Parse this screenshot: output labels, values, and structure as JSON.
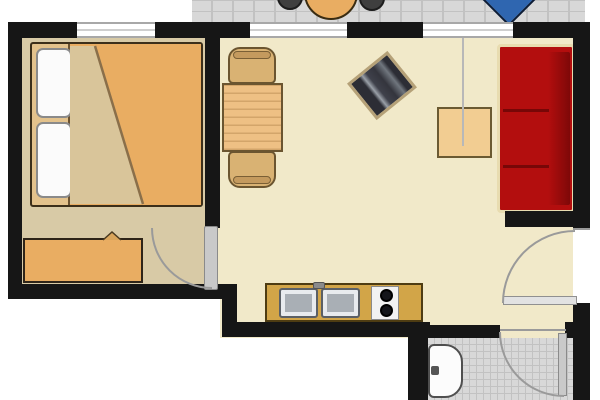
{
  "meta": {
    "type": "apartment-floor-plan",
    "width_px": 600,
    "height_px": 400,
    "text_labels": []
  },
  "palette": {
    "wall": "#161616",
    "exterior": "#ffffff",
    "bedroomFloor": "#d8caa6",
    "livingFloor": "#f1e9c9",
    "tileFloor": "#d8d8d8",
    "tileLine": "#c2c2c2",
    "accentOrange": "#e9ad62",
    "bedFrame": "#e3c28c",
    "foldBeige": "#d9c59a",
    "pillowWhite": "#fbfbfb",
    "woodTable": "#eec084",
    "woodChair": "#d9b273",
    "woodOutline": "#6b5530",
    "counterWood": "#d2a548",
    "sofaRed": "#b30e0e",
    "sofaRedDark": "#7e0808",
    "sofaTrim": "#e8dcb0",
    "coffeeTable": "#f2cd92",
    "tvBody": "#2c2d35",
    "tvStripe": "#9aa0a8",
    "tvFrame": "#b5a178",
    "loungerBlue": "#2f66b0",
    "loungerNavy": "#16335e",
    "doorLeaf": "#c9c9c9",
    "arcLine": "#9a9a9a",
    "sinkSteel": "#a9afb5",
    "stoveWhite": "#f2f2f2",
    "burnerBlack": "#14151a",
    "toiletWhite": "#fcfcfc"
  },
  "rooms": {
    "balcony": {
      "floor": "gray-tile",
      "items": [
        "round-table",
        "chair",
        "chair",
        "sun-lounger"
      ]
    },
    "bedroom": {
      "floor": "tan",
      "items": [
        "double-bed",
        "pillow",
        "pillow",
        "duvet",
        "sideboard"
      ],
      "doors": [
        "door-to-living-room"
      ]
    },
    "living_room": {
      "floor": "cream",
      "items": [
        "dining-table",
        "dining-chair",
        "dining-chair",
        "tv",
        "coffee-table",
        "sofa"
      ],
      "doors": [
        "entrance-door"
      ]
    },
    "kitchenette": {
      "items": [
        "counter",
        "sink-basin",
        "sink-basin",
        "faucet",
        "stove-two-burners"
      ]
    },
    "bathroom": {
      "floor": "gray-tile",
      "items": [
        "toilet"
      ],
      "doors": [
        "door-to-living-room"
      ]
    }
  },
  "openings": {
    "windows": 3,
    "doors": 3
  }
}
